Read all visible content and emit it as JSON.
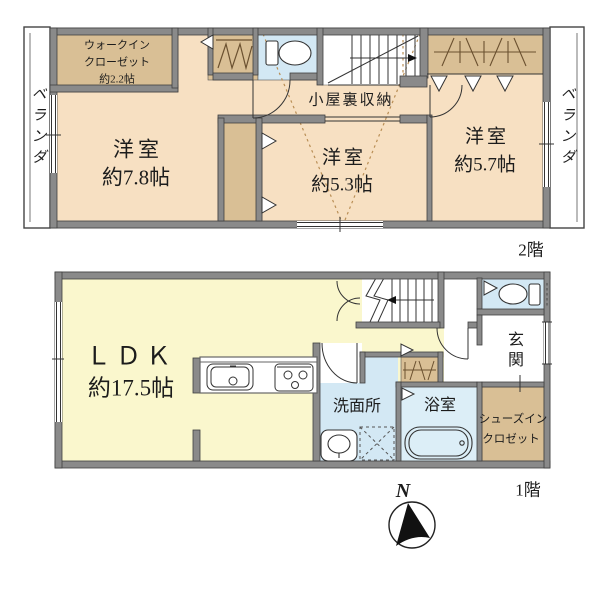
{
  "floor2": {
    "floor_label": "2階",
    "veranda_left": "ベランダ",
    "veranda_right": "ベランダ",
    "walkin_closet": {
      "line1": "ウォークイン",
      "line2": "クローゼット",
      "line3": "約2.2帖"
    },
    "room_west": {
      "name": "洋室",
      "size": "約7.8帖"
    },
    "room_center": {
      "name": "洋室",
      "size": "約5.3帖"
    },
    "room_east": {
      "name": "洋室",
      "size": "約5.7帖"
    },
    "attic_storage": "小屋裏収納"
  },
  "floor1": {
    "floor_label": "1階",
    "ldk": {
      "name": "ＬＤＫ",
      "size": "約17.5帖"
    },
    "washroom": "洗面所",
    "bathroom": "浴室",
    "entrance": "玄関",
    "shoe_closet": {
      "line1": "シューズイン",
      "line2": "クロゼット"
    }
  },
  "compass": {
    "label": "N"
  },
  "colors": {
    "room_peach": "#F7E0C2",
    "closet_tan": "#D9BF95",
    "wet_blue": "#D3E8F4",
    "bath_blue": "#DCEEF7",
    "ldk_yellow": "#FAF7CD",
    "wall_gray": "#8A8A8A",
    "line_dark": "#3F3F3F",
    "dot_brown": "#B98E55"
  }
}
